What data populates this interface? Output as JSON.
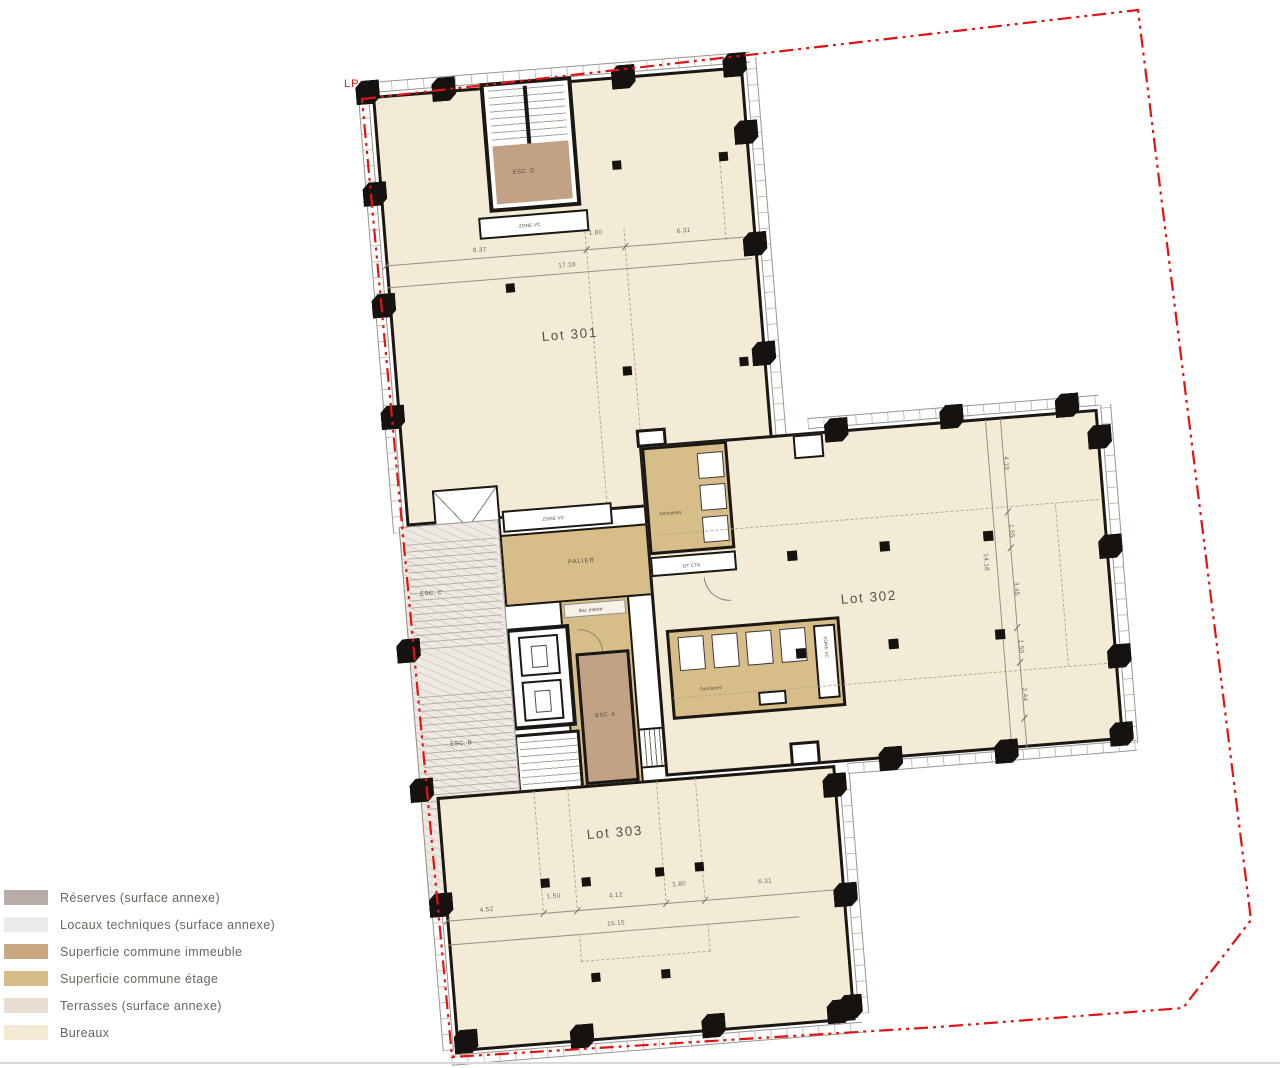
{
  "plan": {
    "lp_label": "LP",
    "lots": {
      "lot301": "Lot 301",
      "lot302": "Lot 302",
      "lot303": "Lot 303"
    },
    "rooms": {
      "esc_a": "ESC. A",
      "esc_b": "ESC. B",
      "esc_c": "ESC. C",
      "esc_d": "ESC. D",
      "palier": "PALIER",
      "sanitaires_upper": "Sanitaires",
      "sanitaires_lower": "Sanitaires",
      "zone_vc_1": "ZONE VC",
      "zone_vc_2": "ZONE VC",
      "zone_vc_3": "ZONE VC",
      "zone_vc_4": "ZONE VC",
      "gt_cta_1": "GT CTA",
      "gt_cta_2": "GT CTA",
      "bac_plante": "Bac plante"
    },
    "dimensions": {
      "top": {
        "segments": [
          "9.37",
          "1.80",
          "6.31"
        ],
        "total": "17.18"
      },
      "bottom": {
        "segments": [
          "4.52",
          "1.50",
          "4.12",
          "1.80",
          "6.31"
        ],
        "total": "16.15"
      },
      "right": {
        "segments": [
          "4.19",
          "1.55",
          "3.45",
          "1.50",
          "2.44"
        ],
        "total": "14.18"
      }
    }
  },
  "legend": {
    "items": [
      {
        "label": "Réserves (surface annexe)",
        "color": "#b7ada6"
      },
      {
        "label": "Locaux techniques (surface annexe)",
        "color": "#eaecec"
      },
      {
        "label": "Superficie commune immeuble",
        "color": "#c8a87e"
      },
      {
        "label": "Superficie commune étage",
        "color": "#d7bd85"
      },
      {
        "label": "Terrasses (surface annexe)",
        "color": "#e8ddd2"
      },
      {
        "label": "Bureaux",
        "color": "#f4ead3"
      }
    ]
  },
  "colors": {
    "bureaux": "#f4ebd6",
    "etage": "#d7bd87",
    "immeuble": "#c2a284",
    "property_line": "#e01414",
    "wall": "#1b1713"
  }
}
